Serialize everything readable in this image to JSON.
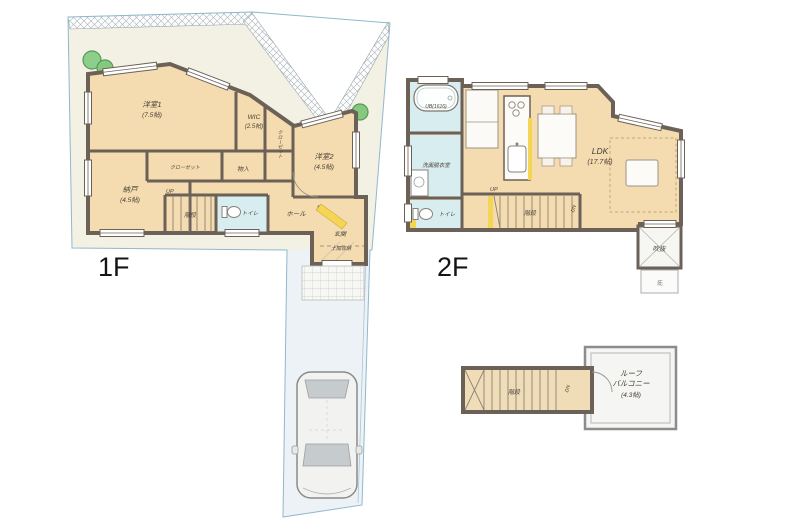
{
  "floors": {
    "f1": {
      "label": "1F",
      "rooms": {
        "room1_name": "洋室1",
        "room1_size": "(7.5帖)",
        "wic_name": "WIC",
        "wic_size": "(2.5帖)",
        "room2_name": "洋室2",
        "room2_size": "(4.5帖)",
        "nando_name": "納戸",
        "nando_size": "(4.5帖)",
        "closet1": "クローゼット",
        "closet2": "クローゼット",
        "monoire": "物入",
        "stairs": "階段",
        "up": "UP",
        "toilet": "トイレ",
        "hall": "ホール",
        "entrance": "玄関",
        "doma": "土間収納"
      }
    },
    "f2": {
      "label": "2F",
      "rooms": {
        "bath": "UB(1616)",
        "washroom": "洗面脱衣室",
        "toilet": "トイレ",
        "ldk_name": "LDK",
        "ldk_size": "(17.7帖)",
        "stairs": "階段",
        "up": "UP",
        "dn": "DN",
        "void": "吹抜",
        "eaves": "庇"
      }
    },
    "roof": {
      "stairs": "階段",
      "dn": "DN",
      "balcony_line1": "ルーフ",
      "balcony_line2": "バルコニー",
      "balcony_size": "(4.3帖)"
    }
  },
  "colors": {
    "floor_beige": "#f4dcb0",
    "wet_room_blue": "#d8edef",
    "wall_dark": "#6b6157",
    "site_garden": "#f2f1e3",
    "driveway": "#edf2f6",
    "site_boundary": "#90b8cc",
    "accent_yellow": "#f5d654",
    "tree_green": "#85c97f"
  }
}
